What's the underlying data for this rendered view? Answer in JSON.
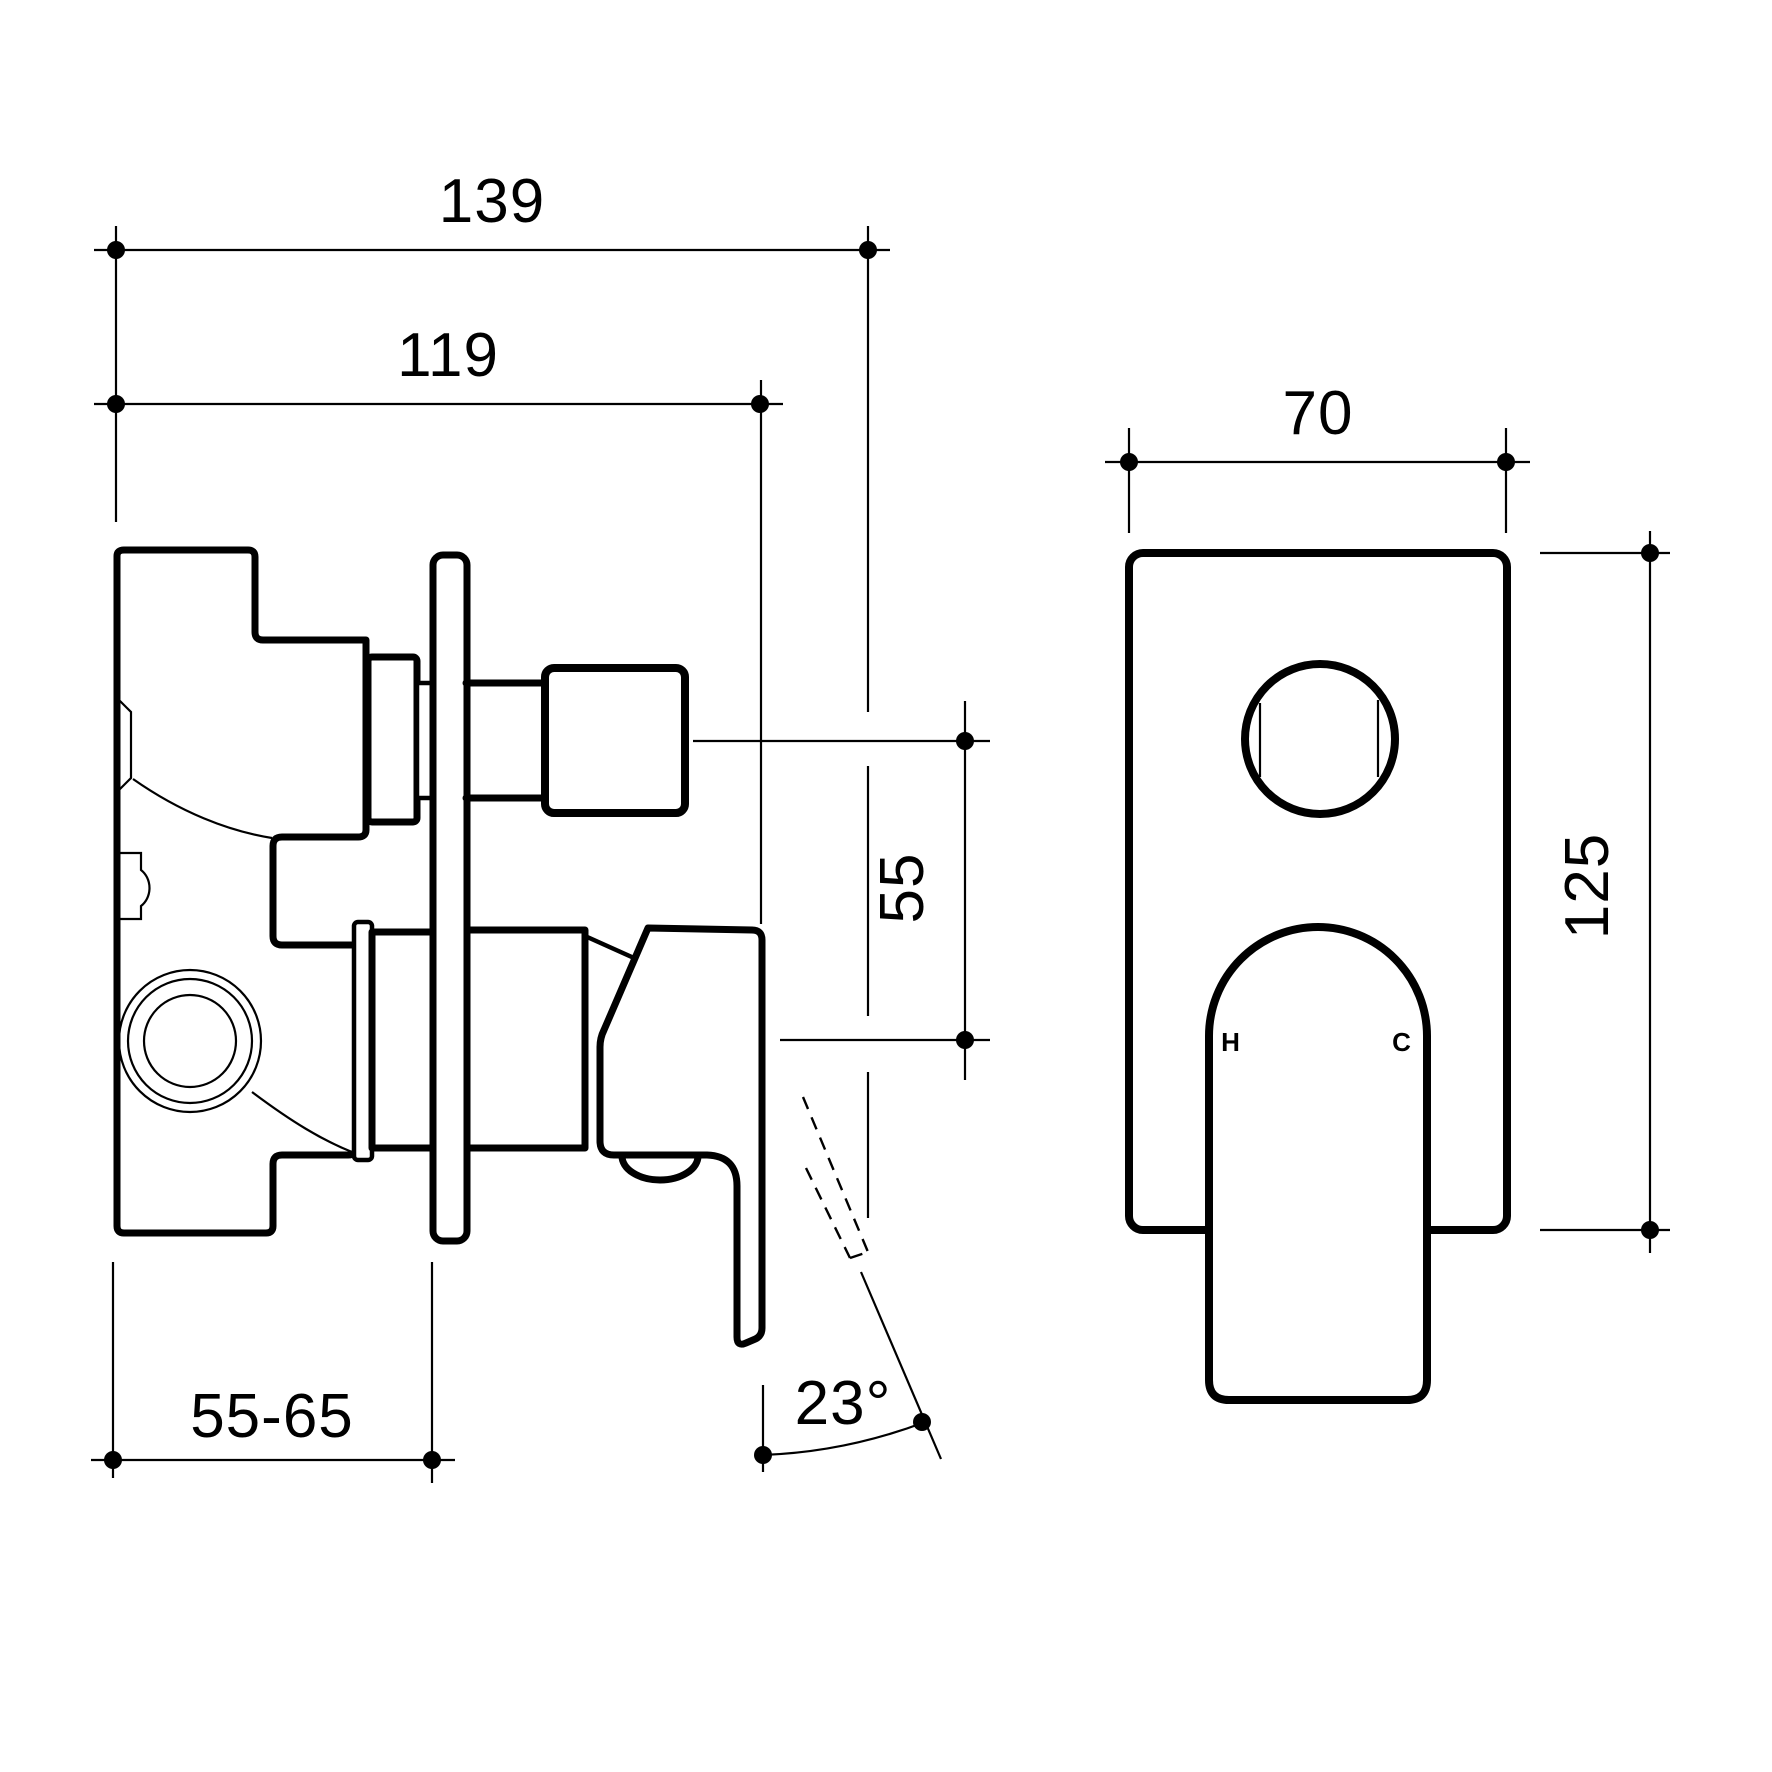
{
  "drawing": {
    "type": "technical-dimension-drawing",
    "subject": "wall-mixer-with-diverter",
    "background": "#ffffff",
    "line_color": "#000000",
    "side_view": {
      "labels": {
        "width_total": "139",
        "width_to_plate": "119",
        "center_spacing": "55",
        "depth_range": "55-65",
        "handle_angle": "23°"
      }
    },
    "front_view": {
      "labels": {
        "plate_width": "70",
        "plate_height": "125",
        "hot": "H",
        "cold": "C"
      }
    }
  }
}
